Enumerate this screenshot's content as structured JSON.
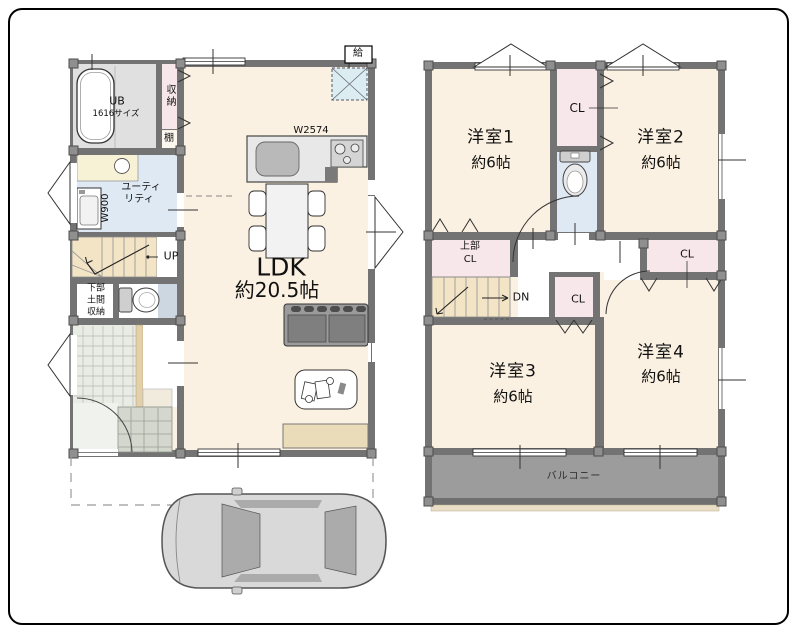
{
  "doc": {
    "type": "floor-plan",
    "floors": [
      "1F",
      "2F"
    ]
  },
  "palette": {
    "wall_gray": "#737373",
    "room_cream": "#fbf1e2",
    "closet_pink": "#f8e7ea",
    "water_blue": "#dfe9f4",
    "stair_beige": "#f4e4c6",
    "balcony_gray": "#9c9c9c",
    "tile_gray": "#d3d7ce",
    "hatch_blue": "#dcedf2",
    "line_black": "#333333"
  },
  "f1": {
    "ub1": "UB",
    "ub2": "1616サイズ",
    "shunou": "収納",
    "tana": "棚",
    "util1": "ユーティ",
    "util2": "リティ",
    "w900": "W900",
    "up": "UP",
    "kabu1": "下部",
    "kabu2": "土間",
    "kabu3": "収納",
    "w2574": "W2574",
    "kyu": "給",
    "ldk1": "LDK",
    "ldk2": "約20.5帖"
  },
  "f2": {
    "r1a": "洋室1",
    "r1b": "約6帖",
    "r2a": "洋室2",
    "r2b": "約6帖",
    "r3a": "洋室3",
    "r3b": "約6帖",
    "r4a": "洋室4",
    "r4b": "約6帖",
    "cl_top": "CL",
    "cl_mid": "CL",
    "cl_right": "CL",
    "ucl1": "上部",
    "ucl2": "CL",
    "dn": "DN",
    "balcony": "バルコニー"
  }
}
